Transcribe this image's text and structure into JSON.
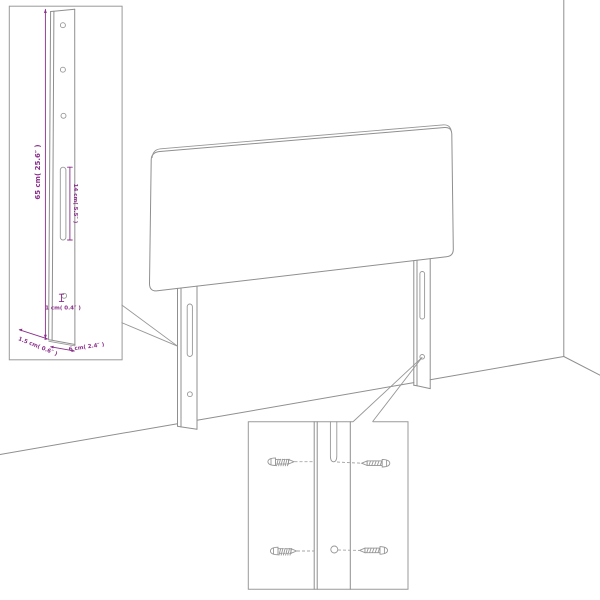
{
  "diagram": {
    "labels": {
      "height": "65 cm( 25.6″ )",
      "slot": "14 cm( 5.5″ )",
      "hole": "1 cm( 0.4″ )",
      "depth": "1.5 cm( 0.6″ )",
      "width": "6 cm( 2.4″ )"
    },
    "colors": {
      "dimension": "#8a2f8a",
      "line": "#8f8f8f",
      "background": "#ffffff"
    }
  }
}
